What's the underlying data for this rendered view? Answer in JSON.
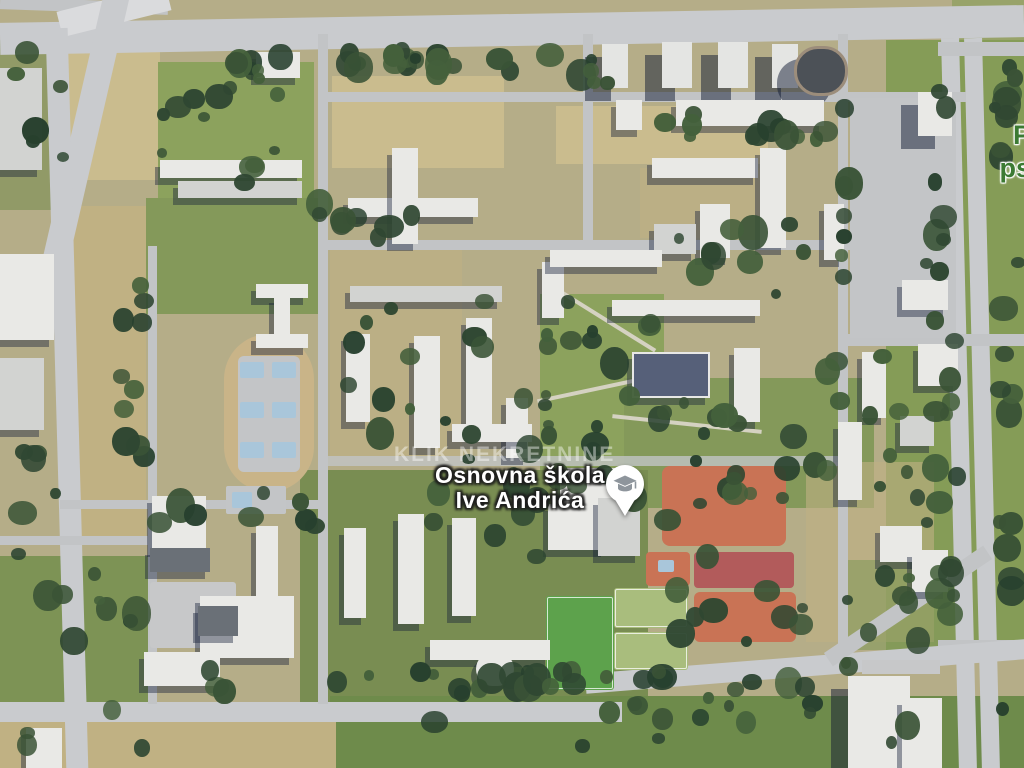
{
  "watermark": {
    "text": "KLIK NEKRETNINE"
  },
  "poi": {
    "name_line1": "Osnovna škola",
    "name_line2": "Ive Andrića",
    "icon": "school-pin-icon",
    "pin_fill": "#ffffff",
    "pin_glyph_color": "#8e959c"
  },
  "edge_label": {
    "line1": "P",
    "line2": "ps",
    "color": "#3c7a33"
  },
  "palette": {
    "dry": "#cabc8e",
    "dry2": "#c0b183",
    "grassPark": "#8ca25d",
    "grassPark2": "#84995a",
    "grassDull": "#7d9355",
    "grassDull2": "#798d52",
    "gardens": "#6e8b4b",
    "grassVerge": "#859c57",
    "roadMain": "#c9cbce",
    "road": "#c2c4c6",
    "roadLight": "#dadbdd",
    "path": "#d5d2c2",
    "plaza": "#c7c8c9",
    "bld": "#e9e9e6",
    "bldGray": "#d2d3d1",
    "bldDark": "#6a7077",
    "bldTower": "#e4e5e3",
    "bldBlueRoof": "#566079",
    "bldDomeDark": "#4c5157",
    "track": "#c9b488",
    "courtConcrete": "#c3c5c7",
    "courtBlue": "#a9c6da",
    "courtOrange": "#c97355",
    "courtRed": "#b25b5b",
    "fieldPale": "#a9bd7d",
    "fieldGreen": "#5da24c"
  },
  "map_features": {
    "layers": [
      {
        "name": "ground-patch",
        "cls": "patch",
        "items": [
          [
            64,
            40,
            96,
            140,
            "dry"
          ],
          [
            158,
            62,
            156,
            148,
            "grassPark"
          ],
          [
            332,
            76,
            172,
            92,
            "dry"
          ],
          [
            556,
            106,
            212,
            58,
            "dry"
          ],
          [
            60,
            206,
            86,
            330,
            "dry2"
          ],
          [
            146,
            198,
            176,
            116,
            "grassPark2"
          ],
          [
            330,
            246,
            132,
            216,
            "dry2",
            0,
            0,
            "o60"
          ],
          [
            540,
            294,
            124,
            190,
            "grassPark"
          ],
          [
            624,
            378,
            250,
            130,
            "grassPark2"
          ],
          [
            300,
            470,
            348,
            246,
            "grassDull2"
          ],
          [
            886,
            40,
            138,
            610,
            "grassVerge"
          ],
          [
            0,
            556,
            148,
            214,
            "grassDull"
          ],
          [
            330,
            696,
            704,
            72,
            "gardens",
            0,
            0,
            "plots"
          ],
          [
            0,
            722,
            336,
            46,
            "dry2"
          ],
          [
            806,
            462,
            128,
            180,
            "dry2",
            0,
            0,
            "o60"
          ],
          [
            0,
            40,
            62,
            170,
            "grassDull2",
            0,
            0,
            "o60"
          ],
          [
            846,
            560,
            120,
            90,
            "grassPark2",
            0,
            0,
            "o60"
          ],
          [
            640,
            168,
            130,
            70,
            "dry2",
            0,
            0,
            "o60"
          ],
          [
            952,
            0,
            72,
            44,
            "grassVerge",
            0,
            0,
            "o60"
          ]
        ]
      },
      {
        "name": "road",
        "cls": "roadf",
        "items": [
          [
            0,
            14,
            1024,
            32,
            "roadMain",
            0,
            -1,
            "lanes"
          ],
          [
            0,
            0,
            168,
            12,
            "road",
            0,
            2
          ],
          [
            58,
            -2,
            112,
            26,
            "roadLight",
            0,
            -14,
            "gore"
          ],
          [
            74,
            -16,
            26,
            280,
            "roadMain",
            0,
            13
          ],
          [
            56,
            28,
            22,
            744,
            "roadMain",
            0,
            -1.6
          ],
          [
            950,
            38,
            18,
            732,
            "roadMain",
            0,
            -1.4
          ],
          [
            973,
            38,
            18,
            732,
            "roadMain",
            0,
            -1.4
          ],
          [
            938,
            42,
            86,
            14,
            "road"
          ],
          [
            845,
            334,
            180,
            12,
            "road"
          ],
          [
            938,
            640,
            86,
            14,
            "road"
          ],
          [
            0,
            702,
            622,
            20,
            "roadMain"
          ],
          [
            585,
            656,
            452,
            20,
            "roadMain",
            0,
            -4.5
          ],
          [
            812,
            598,
            192,
            16,
            "road",
            0,
            -34
          ],
          [
            318,
            34,
            10,
            670,
            "road"
          ],
          [
            583,
            34,
            10,
            214,
            "road"
          ],
          [
            838,
            34,
            10,
            612,
            "road"
          ],
          [
            148,
            246,
            9,
            458,
            "road"
          ],
          [
            318,
            92,
            648,
            10,
            "road"
          ],
          [
            318,
            240,
            532,
            10,
            "road"
          ],
          [
            318,
            456,
            528,
            10,
            "road",
            0,
            0,
            "o80"
          ],
          [
            60,
            500,
            262,
            9,
            "road"
          ],
          [
            0,
            536,
            152,
            9,
            "road"
          ],
          [
            850,
            98,
            106,
            240,
            "courtConcrete",
            0,
            0,
            "parkingLot"
          ],
          [
            548,
            318,
            116,
            4,
            "path",
            0,
            32
          ],
          [
            536,
            386,
            128,
            4,
            "path",
            0,
            -12
          ],
          [
            612,
            422,
            150,
            4,
            "path",
            0,
            6
          ]
        ]
      },
      {
        "name": "sport-area",
        "cls": "court",
        "items": [
          [
            224,
            334,
            90,
            158,
            "track",
            45
          ],
          [
            238,
            356,
            62,
            116,
            "courtConcrete",
            6
          ],
          [
            240,
            362,
            24,
            16,
            "courtBlue",
            2
          ],
          [
            272,
            362,
            24,
            16,
            "courtBlue",
            2
          ],
          [
            240,
            402,
            24,
            16,
            "courtBlue",
            2
          ],
          [
            272,
            402,
            24,
            16,
            "courtBlue",
            2
          ],
          [
            240,
            442,
            24,
            16,
            "courtBlue",
            2
          ],
          [
            272,
            442,
            24,
            16,
            "courtBlue",
            2
          ],
          [
            226,
            486,
            60,
            28,
            "courtConcrete",
            2
          ],
          [
            232,
            492,
            20,
            16,
            "courtBlue",
            2
          ],
          [
            662,
            466,
            124,
            80,
            "courtOrange",
            8
          ],
          [
            694,
            552,
            100,
            36,
            "courtRed",
            4
          ],
          [
            646,
            552,
            44,
            34,
            "courtOrange",
            4
          ],
          [
            658,
            560,
            16,
            12,
            "courtBlue",
            2
          ],
          [
            694,
            592,
            102,
            50,
            "courtOrange",
            6
          ],
          [
            614,
            588,
            74,
            40,
            "fieldPale",
            3,
            0,
            "lined"
          ],
          [
            614,
            632,
            74,
            38,
            "fieldPale",
            3,
            0,
            "lined"
          ],
          [
            546,
            596,
            68,
            94,
            "fieldGreen",
            3,
            0,
            "stripes lined"
          ],
          [
            150,
            582,
            86,
            66,
            "plaza",
            3
          ]
        ]
      },
      {
        "name": "building",
        "cls": "b",
        "items": [
          [
            0,
            68,
            42,
            102,
            "bldGray"
          ],
          [
            0,
            254,
            54,
            86,
            "bld"
          ],
          [
            0,
            358,
            44,
            72,
            "bldGray"
          ],
          [
            26,
            728,
            36,
            40,
            "bld"
          ],
          [
            256,
            52,
            44,
            26,
            "bld"
          ],
          [
            160,
            160,
            142,
            18,
            "bld"
          ],
          [
            178,
            181,
            124,
            17,
            "bldGray"
          ],
          [
            256,
            284,
            52,
            14,
            "bld"
          ],
          [
            274,
            296,
            16,
            40,
            "bld"
          ],
          [
            256,
            334,
            52,
            14,
            "bld"
          ],
          [
            348,
            198,
            130,
            19,
            "bld"
          ],
          [
            392,
            148,
            26,
            96,
            "bld"
          ],
          [
            350,
            286,
            152,
            16,
            "bldGray"
          ],
          [
            602,
            44,
            26,
            44,
            "bldTower",
            0,
            0,
            "tower"
          ],
          [
            662,
            42,
            30,
            46,
            "bldTower",
            0,
            0,
            "tower"
          ],
          [
            718,
            42,
            30,
            46,
            "bldTower",
            0,
            0,
            "tower"
          ],
          [
            772,
            44,
            26,
            44,
            "bldTower",
            0,
            0,
            "tower"
          ],
          [
            794,
            46,
            48,
            44,
            "bldDomeDark",
            24,
            0,
            "ring tower"
          ],
          [
            616,
            100,
            26,
            30,
            "bld"
          ],
          [
            676,
            100,
            148,
            26,
            "bld"
          ],
          [
            918,
            92,
            34,
            44,
            "bld",
            0,
            0,
            "tower"
          ],
          [
            652,
            158,
            106,
            20,
            "bld"
          ],
          [
            760,
            148,
            26,
            100,
            "bld"
          ],
          [
            700,
            204,
            30,
            54,
            "bld"
          ],
          [
            654,
            224,
            42,
            30,
            "bldGray"
          ],
          [
            824,
            204,
            20,
            56,
            "bld"
          ],
          [
            902,
            280,
            46,
            30,
            "bld"
          ],
          [
            918,
            344,
            40,
            42,
            "bld"
          ],
          [
            862,
            352,
            24,
            66,
            "bld"
          ],
          [
            838,
            422,
            24,
            78,
            "bld"
          ],
          [
            900,
            416,
            34,
            30,
            "bldGray"
          ],
          [
            542,
            262,
            22,
            56,
            "bld"
          ],
          [
            550,
            250,
            112,
            17,
            "bld"
          ],
          [
            612,
            300,
            148,
            16,
            "bld"
          ],
          [
            632,
            352,
            74,
            42,
            "bldBlueRoof",
            0,
            0,
            "trim"
          ],
          [
            734,
            348,
            26,
            74,
            "bld"
          ],
          [
            346,
            334,
            24,
            88,
            "bld"
          ],
          [
            414,
            336,
            26,
            112,
            "bld"
          ],
          [
            466,
            318,
            26,
            112,
            "bld"
          ],
          [
            506,
            398,
            22,
            60,
            "bld"
          ],
          [
            452,
            424,
            80,
            18,
            "bld"
          ],
          [
            560,
            468,
            66,
            38,
            "bld"
          ],
          [
            548,
            504,
            58,
            46,
            "bld"
          ],
          [
            598,
            498,
            42,
            58,
            "bldGray"
          ],
          [
            398,
            514,
            26,
            110,
            "bld"
          ],
          [
            452,
            518,
            24,
            98,
            "bld"
          ],
          [
            344,
            528,
            22,
            90,
            "bld"
          ],
          [
            430,
            640,
            120,
            20,
            "bld"
          ],
          [
            476,
            652,
            38,
            34,
            "bld",
            19
          ],
          [
            152,
            496,
            54,
            54,
            "bld"
          ],
          [
            150,
            548,
            60,
            24,
            "bldDark"
          ],
          [
            256,
            526,
            22,
            76,
            "bld"
          ],
          [
            200,
            596,
            94,
            62,
            "bld"
          ],
          [
            198,
            606,
            40,
            30,
            "bldDark"
          ],
          [
            144,
            652,
            76,
            34,
            "bld"
          ],
          [
            848,
            676,
            62,
            92,
            "bld",
            0,
            0,
            "tower"
          ],
          [
            902,
            698,
            40,
            70,
            "bld"
          ],
          [
            880,
            526,
            42,
            36,
            "bld"
          ],
          [
            912,
            550,
            36,
            42,
            "bld"
          ],
          [
            862,
            660,
            78,
            14,
            "plaza",
            0,
            0,
            "flat"
          ]
        ]
      }
    ],
    "trees": {
      "colors": [
        "#3a5336",
        "#2f4732",
        "#44603b",
        "#27402e"
      ],
      "clusters": [
        [
          225,
          42,
          345,
          42,
          26,
          11
        ],
        [
          150,
          60,
          160,
          150,
          12,
          22
        ],
        [
          630,
          104,
          210,
          44,
          12,
          33
        ],
        [
          290,
          186,
          130,
          64,
          8,
          44
        ],
        [
          330,
          246,
          230,
          220,
          16,
          55
        ],
        [
          540,
          286,
          130,
          200,
          14,
          66
        ],
        [
          415,
          425,
          240,
          145,
          18,
          77
        ],
        [
          620,
          385,
          260,
          125,
          14,
          88
        ],
        [
          655,
          195,
          190,
          105,
          10,
          99
        ],
        [
          795,
          335,
          150,
          170,
          10,
          110
        ],
        [
          625,
          455,
          190,
          200,
          16,
          121
        ],
        [
          165,
          660,
          680,
          44,
          30,
          132
        ],
        [
          0,
          552,
          155,
          210,
          12,
          143
        ],
        [
          112,
          225,
          44,
          290,
          10,
          154
        ],
        [
          378,
          695,
          575,
          65,
          14,
          165
        ],
        [
          818,
          556,
          125,
          125,
          9,
          176
        ],
        [
          920,
          46,
          48,
          590,
          24,
          187
        ],
        [
          988,
          36,
          38,
          710,
          20,
          198
        ],
        [
          0,
          36,
          70,
          150,
          6,
          209
        ],
        [
          0,
          425,
          62,
          150,
          6,
          220
        ],
        [
          560,
          54,
          64,
          38,
          5,
          231
        ],
        [
          146,
          480,
          180,
          70,
          8,
          242
        ],
        [
          834,
          96,
          20,
          246,
          7,
          253
        ]
      ]
    }
  }
}
